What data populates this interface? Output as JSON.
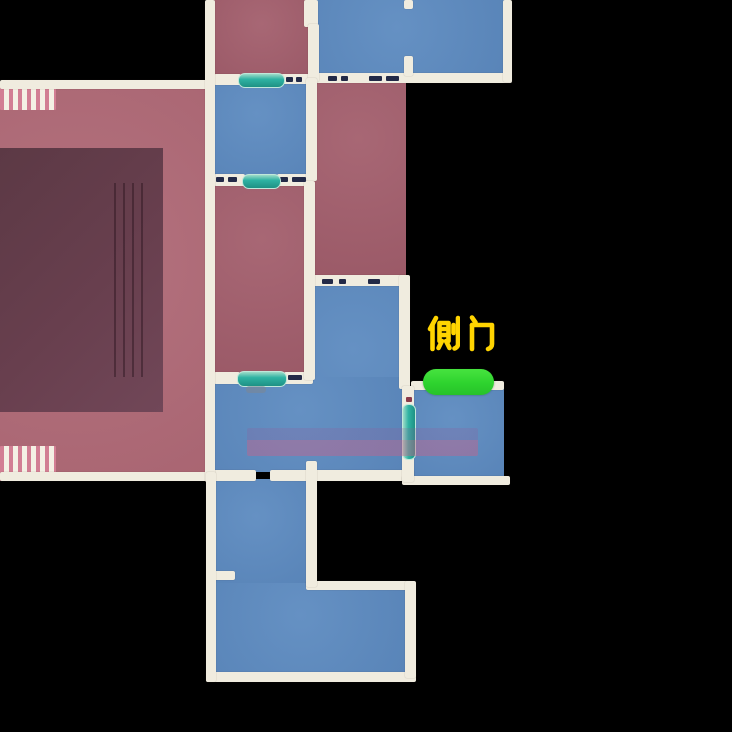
{
  "map": {
    "kind": "indoor floor plan minimap",
    "label": {
      "text": "侧门"
    },
    "marker": {
      "name": "side-door-marker",
      "shape": "pill",
      "color": "#2ed32e"
    },
    "door_markers": {
      "name": "door-marker-teal",
      "count": 4,
      "color": "#2fb3a3"
    },
    "colors": {
      "background": "#000000",
      "room_blue": "#5d8bc0",
      "room_red": "#a35f6d",
      "hall_red": "#b06a77",
      "stage_dark": "#63404d",
      "wall_cream": "#f0ecdf",
      "door_teal": "#2fb3a3",
      "label_yellow": "#ffd400",
      "marker_green": "#2ed32e",
      "floor_band_pink": "#cd5f87",
      "door_frame_dash": "#232a47"
    }
  }
}
